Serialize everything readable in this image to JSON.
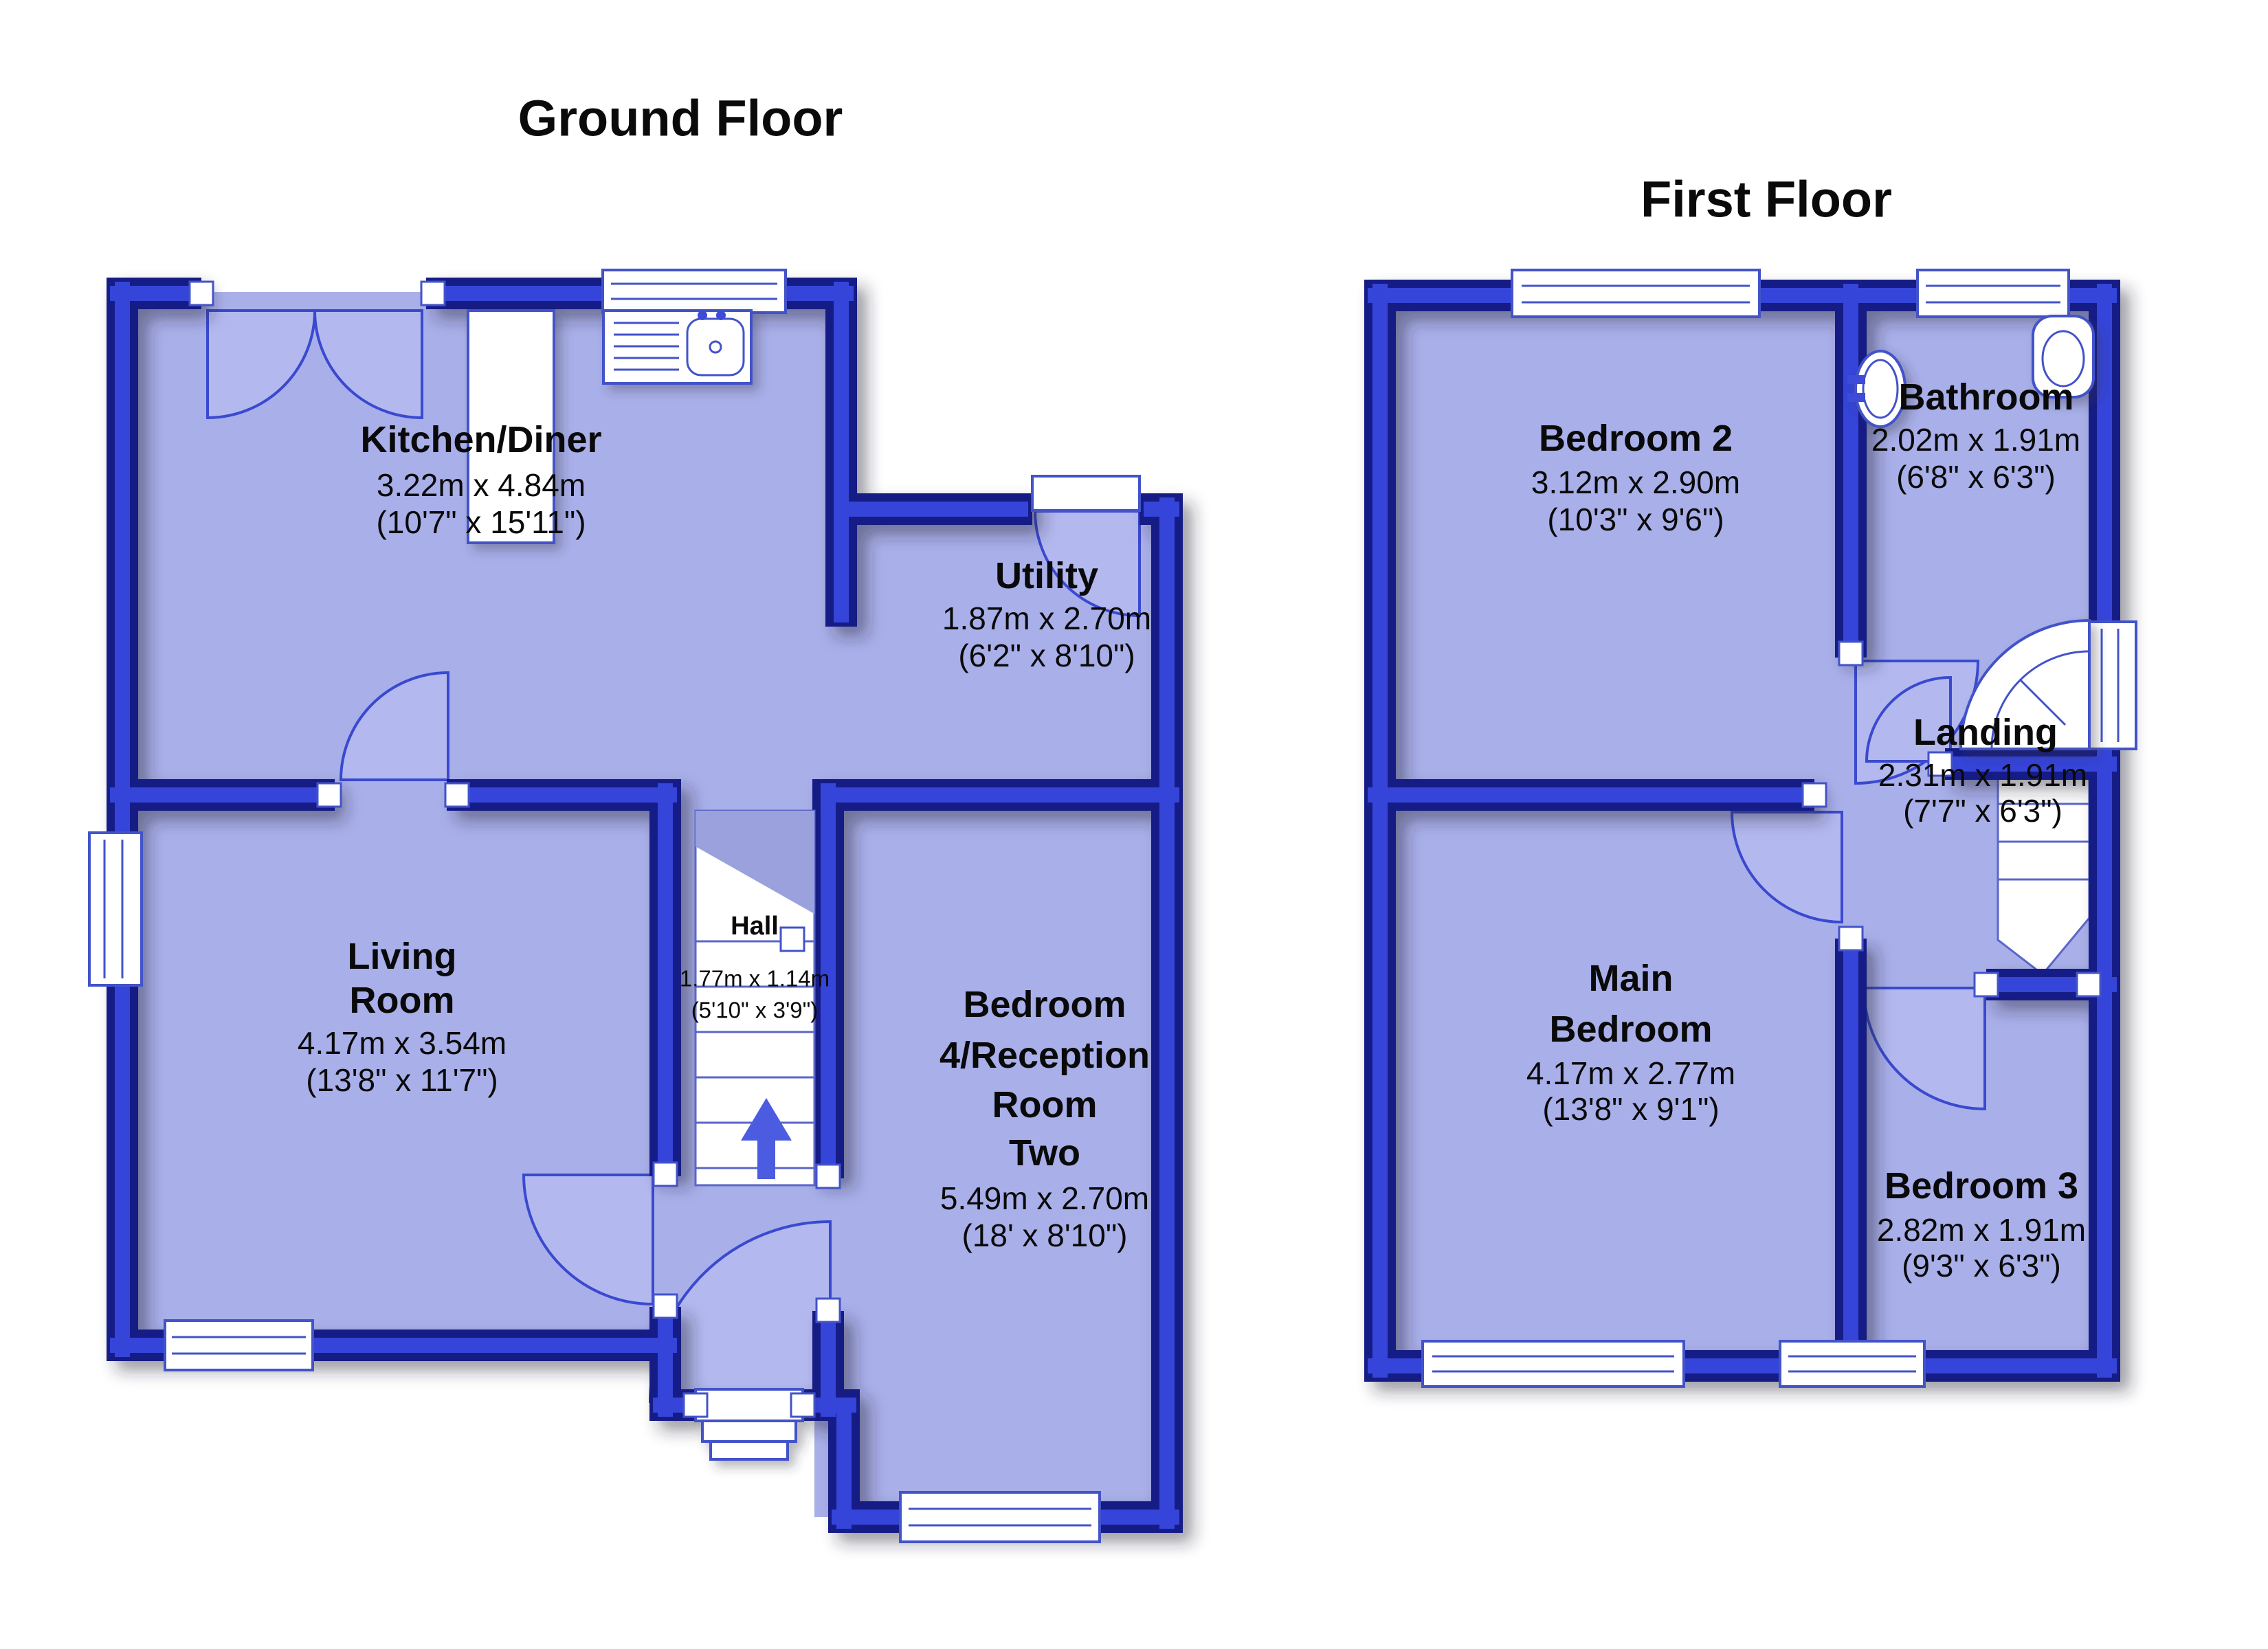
{
  "colors": {
    "wall_dark": "#151d85",
    "wall_mid": "#3445d9",
    "room_fill": "#a9afe9",
    "fixture_outline": "#4353c9",
    "stairs_arrow": "#4c5ce0",
    "label_text": "#0a0a0a",
    "background": "#ffffff"
  },
  "ground_floor": {
    "title": "Ground Floor",
    "rooms": {
      "kitchen": {
        "name": "Kitchen/Diner",
        "size_m": "3.22m x 4.84m",
        "size_ft": "(10'7\" x 15'11\")"
      },
      "utility": {
        "name": "Utility",
        "size_m": "1.87m x 2.70m",
        "size_ft": "(6'2\" x 8'10\")"
      },
      "living": {
        "name_line1": "Living",
        "name_line2": "Room",
        "size_m": "4.17m x 3.54m",
        "size_ft": "(13'8\" x 11'7\")"
      },
      "hall": {
        "name": "Hall",
        "size_m": "1.77m x 1.14m",
        "size_ft": "(5'10\" x 3'9\")"
      },
      "bedroom4": {
        "name_line1": "Bedroom",
        "name_line2": "4/Reception",
        "name_line3": "Room",
        "name_line4": "Two",
        "size_m": "5.49m x 2.70m",
        "size_ft": "(18' x 8'10\")"
      }
    }
  },
  "first_floor": {
    "title": "First Floor",
    "rooms": {
      "bedroom2": {
        "name": "Bedroom 2",
        "size_m": "3.12m x 2.90m",
        "size_ft": "(10'3\" x 9'6\")"
      },
      "bathroom": {
        "name": "Bathroom",
        "size_m": "2.02m x 1.91m",
        "size_ft": "(6'8\" x 6'3\")"
      },
      "landing": {
        "name": "Landing",
        "size_m": "2.31m x 1.91m",
        "size_ft": "(7'7\" x 6'3\")"
      },
      "main_bedroom": {
        "name_line1": "Main",
        "name_line2": "Bedroom",
        "size_m": "4.17m x 2.77m",
        "size_ft": "(13'8\" x 9'1\")"
      },
      "bedroom3": {
        "name": "Bedroom 3",
        "size_m": "2.82m x 1.91m",
        "size_ft": "(9'3\" x 6'3\")"
      }
    }
  }
}
